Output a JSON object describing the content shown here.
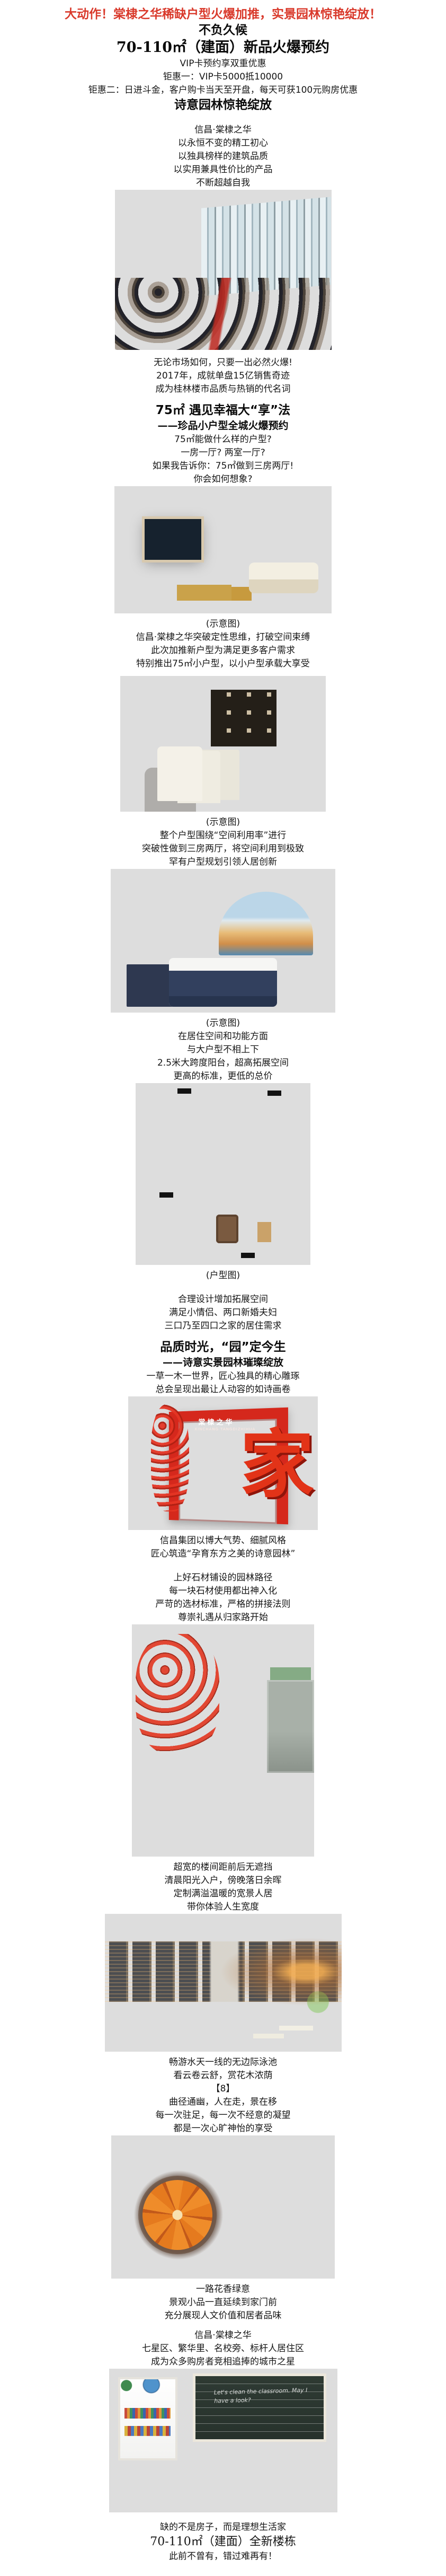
{
  "article": {
    "accent_red": "#d9392b",
    "blocks": [
      {
        "type": "h1",
        "name": "headline-main",
        "text": "大动作！棠棣之华稀缺户型火爆加推，实景园林惊艳绽放！"
      },
      {
        "type": "h2",
        "name": "heading-wait",
        "text": "不负久候"
      },
      {
        "type": "h2s",
        "name": "heading-area-preorder",
        "text": "70-110㎡（建面）新品火爆预约"
      },
      {
        "type": "p",
        "text": "VIP卡预约享双重优惠"
      },
      {
        "type": "p",
        "text": "钜惠一：VIP卡5000抵10000"
      },
      {
        "type": "p",
        "text": "钜惠二：日进斗金，客户购卡当天至开盘，每天可获100元购房优惠"
      },
      {
        "type": "h2",
        "name": "heading-garden-bloom",
        "text": "诗意园林惊艳绽放"
      },
      {
        "type": "sp",
        "size": "20"
      },
      {
        "type": "p",
        "text": "信昌·棠棣之华"
      },
      {
        "type": "p",
        "text": "以永恒不变的精工初心"
      },
      {
        "type": "p",
        "text": "以独具榜样的建筑品质"
      },
      {
        "type": "p",
        "text": "以实用兼具性价比的产品"
      },
      {
        "type": "p",
        "text": "不断超越自我"
      },
      {
        "type": "img",
        "name": "photo-sales-center"
      },
      {
        "type": "sp",
        "size": "12"
      },
      {
        "type": "p",
        "text": "无论市场如何，只要一出必然火爆!"
      },
      {
        "type": "p",
        "text": "2017年，成就单盘15亿销售奇迹"
      },
      {
        "type": "p",
        "text": "成为桂林楼市品质与热销的代名词"
      },
      {
        "type": "sp",
        "size": "12"
      },
      {
        "type": "h2",
        "name": "heading-75-enjoy",
        "text": "75㎡ 遇见幸福大“享”法"
      },
      {
        "type": "h3",
        "name": "subheading-small-unit",
        "text": "——珍品小户型全城火爆预约"
      },
      {
        "type": "p",
        "text": "75㎡能做什么样的户型?"
      },
      {
        "type": "p",
        "text": "一房一厅? 两室一厅?"
      },
      {
        "type": "p",
        "text": "如果我告诉你：75㎡做到三房两厅!"
      },
      {
        "type": "p",
        "text": "你会如何想象?"
      },
      {
        "type": "img",
        "name": "photo-living-room"
      },
      {
        "type": "sp",
        "size": "8"
      },
      {
        "type": "cap",
        "text": "(示意图)"
      },
      {
        "type": "p",
        "text": "信昌·棠棣之华突破定性思维，打破空间束缚"
      },
      {
        "type": "p",
        "text": "此次加推新户型为满足更多客户需求"
      },
      {
        "type": "p",
        "text": "特别推出75㎡小户型，以小户型承载大享受"
      },
      {
        "type": "sp",
        "size": "10"
      },
      {
        "type": "img",
        "name": "photo-dining-room"
      },
      {
        "type": "sp",
        "size": "8"
      },
      {
        "type": "cap",
        "text": "(示意图)"
      },
      {
        "type": "p",
        "text": "整个户型围绕“空间利用率”进行"
      },
      {
        "type": "p",
        "text": "突破性做到三房两厅，将空间利用到极致"
      },
      {
        "type": "p",
        "text": "罕有户型规划引领人居创新"
      },
      {
        "type": "img",
        "name": "photo-bedroom"
      },
      {
        "type": "sp",
        "size": "8"
      },
      {
        "type": "cap",
        "text": "(示意图)"
      },
      {
        "type": "p",
        "text": "在居住空间和功能方面"
      },
      {
        "type": "p",
        "text": "与大户型不相上下"
      },
      {
        "type": "p",
        "text": "2.5米大跨度阳台，超高拓展空间"
      },
      {
        "type": "p",
        "text": "更高的标准，更低的总价"
      },
      {
        "type": "img",
        "name": "photo-floor-plan"
      },
      {
        "type": "sp",
        "size": "8"
      },
      {
        "type": "cap",
        "text": "(户型图)"
      },
      {
        "type": "sp",
        "size": "20"
      },
      {
        "type": "p",
        "text": "合理设计增加拓展空间"
      },
      {
        "type": "p",
        "text": "满足小情侣、两口新婚夫妇"
      },
      {
        "type": "p",
        "text": "三口乃至四口之家的居住需求"
      },
      {
        "type": "sp",
        "size": "12"
      },
      {
        "type": "h2",
        "name": "heading-quality-time",
        "text": "品质时光，“园”定今生"
      },
      {
        "type": "h3",
        "name": "subheading-garden-bloom",
        "text": "——诗意实景园林璀璨绽放"
      },
      {
        "type": "p",
        "text": "一草一木一世界，匠心独具的精心雕琢"
      },
      {
        "type": "p",
        "text": "总会呈现出最让人动容的如诗画卷"
      },
      {
        "type": "img",
        "name": "photo-red-gate",
        "overlays": [
          {
            "cls": "gate-sign",
            "name": "gate-sign-text",
            "text": "棠棣之华"
          },
          {
            "cls": "gate-sign-sub",
            "name": "gate-sign-pinyin",
            "text": "XINCHANG TANGDIZHIHUA"
          },
          {
            "cls": "gate-glyph",
            "name": "gate-jia-character",
            "text": "家"
          }
        ]
      },
      {
        "type": "sp",
        "size": "8"
      },
      {
        "type": "p",
        "text": "信昌集团以博大气势、细腻风格"
      },
      {
        "type": "p",
        "text": "匠心筑造“孕育东方之美的诗意园林”"
      },
      {
        "type": "sp",
        "size": "20"
      },
      {
        "type": "p",
        "text": "上好石材铺设的园林路径"
      },
      {
        "type": "p",
        "text": "每一块石材使用都出神入化"
      },
      {
        "type": "p",
        "text": "严苛的选材标准，严格的拼接法则"
      },
      {
        "type": "p",
        "text": "尊崇礼遇从归家路开始"
      },
      {
        "type": "img",
        "name": "photo-garden-path"
      },
      {
        "type": "sp",
        "size": "8"
      },
      {
        "type": "p",
        "text": "超宽的楼间距前后无遮挡"
      },
      {
        "type": "p",
        "text": "清晨阳光入户，傍晚落日余晖"
      },
      {
        "type": "p",
        "text": "定制满溢温暖的宽景人居"
      },
      {
        "type": "p",
        "text": "带你体验人生宽度"
      },
      {
        "type": "img",
        "name": "photo-pool-dusk"
      },
      {
        "type": "sp",
        "size": "8"
      },
      {
        "type": "p",
        "text": "畅游水天一线的无边际泳池"
      },
      {
        "type": "p",
        "text": "看云卷云舒，赏花木浓荫"
      },
      {
        "type": "p",
        "text": "【8】"
      },
      {
        "type": "p",
        "text": "曲径通幽，人在走，景在移"
      },
      {
        "type": "p",
        "text": "每一次驻足，每一次不经意的凝望"
      },
      {
        "type": "p",
        "text": "都是一次心旷神怡的享受"
      },
      {
        "type": "img",
        "name": "photo-aerial-pool"
      },
      {
        "type": "sp",
        "size": "8"
      },
      {
        "type": "p",
        "text": "一路花香绿意"
      },
      {
        "type": "p",
        "text": "景观小品一直延续到家门前"
      },
      {
        "type": "p",
        "text": "充分展现人文价值和居者品味"
      },
      {
        "type": "sp",
        "size": "12"
      },
      {
        "type": "p",
        "text": "信昌·棠棣之华"
      },
      {
        "type": "p",
        "text": "七星区、繁华里、名校旁、标杆人居住区"
      },
      {
        "type": "p",
        "text": "成为众多购房者竞相追捧的城市之星"
      },
      {
        "type": "img",
        "name": "photo-classroom",
        "overlays": [
          {
            "cls": "chalk",
            "name": "blackboard-chalk-text",
            "text": "Let's clean the classroom. May I have a look?"
          }
        ]
      },
      {
        "type": "sp",
        "size": "16"
      },
      {
        "type": "p",
        "text": "缺的不是房子，而是理想生活家"
      },
      {
        "type": "serif2",
        "name": "body-line-area",
        "text": "70-110㎡（建面）全新楼栋"
      },
      {
        "type": "p",
        "text": "此前不曾有，错过难再有！"
      }
    ]
  }
}
